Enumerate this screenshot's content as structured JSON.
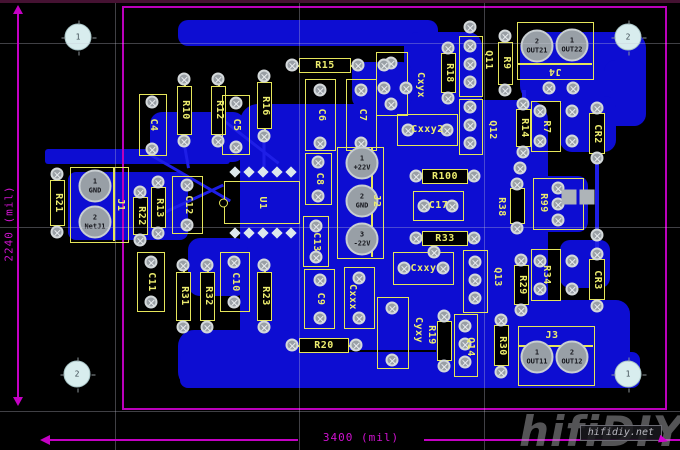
{
  "view": {
    "type": "pcb-layout-editor"
  },
  "board": {
    "x": 122,
    "y": 6,
    "w": 545,
    "h": 404
  },
  "colors": {
    "background": "#000000",
    "copper": "#0d0dd2",
    "silkscreen": "#e6e65a",
    "board_outline": "#bb00bb",
    "pad": "#9aa0a6",
    "dimension": "#cf12cf"
  },
  "dimensions": {
    "vertical": "2240 (mil)",
    "horizontal": "3400 (mil)"
  },
  "watermark": {
    "big": "hifiDIY",
    "small": "hifidiy.net"
  },
  "grid": {
    "v": [
      115,
      299,
      484
    ],
    "h": [
      43,
      227,
      411
    ]
  },
  "copper": {
    "pours": [
      [
        178,
        20,
        260,
        26,
        10
      ],
      [
        404,
        32,
        78,
        84,
        14
      ],
      [
        520,
        32,
        126,
        70,
        16
      ],
      [
        604,
        60,
        42,
        66,
        12
      ],
      [
        352,
        62,
        60,
        46,
        10
      ],
      [
        240,
        104,
        290,
        246,
        18
      ],
      [
        150,
        112,
        95,
        50,
        12
      ],
      [
        45,
        149,
        185,
        15,
        3
      ],
      [
        68,
        172,
        120,
        68,
        8
      ],
      [
        188,
        238,
        60,
        58,
        12
      ],
      [
        178,
        330,
        122,
        58,
        16
      ],
      [
        180,
        352,
        460,
        36,
        8
      ],
      [
        436,
        100,
        112,
        270,
        20
      ],
      [
        528,
        176,
        60,
        56,
        10
      ],
      [
        524,
        300,
        106,
        78,
        14
      ],
      [
        560,
        96,
        56,
        56,
        12
      ],
      [
        560,
        240,
        50,
        48,
        10
      ]
    ],
    "segments": [
      [
        148,
        152,
        95,
        30,
        3
      ],
      [
        158,
        214,
        72,
        -25,
        3
      ],
      [
        225,
        120,
        68,
        38,
        3
      ],
      [
        597,
        160,
        92,
        90,
        4
      ],
      [
        264,
        136,
        30,
        90,
        3
      ],
      [
        184,
        141,
        26,
        80,
        3
      ],
      [
        524,
        88,
        46,
        90,
        4
      ],
      [
        470,
        97,
        12,
        90,
        4
      ]
    ]
  },
  "components": [
    {
      "id": "C4",
      "label": "C4",
      "type": "cap",
      "x": 139,
      "y": 94,
      "w": 28,
      "h": 62,
      "rot": "v"
    },
    {
      "id": "R10",
      "label": "R10",
      "type": "res",
      "x": 177,
      "y": 77,
      "w": 15,
      "h": 66,
      "rot": "v"
    },
    {
      "id": "R12",
      "label": "R12",
      "type": "res",
      "x": 211,
      "y": 77,
      "w": 15,
      "h": 66,
      "rot": "v"
    },
    {
      "id": "C5",
      "label": "C5",
      "type": "cap",
      "x": 222,
      "y": 95,
      "w": 28,
      "h": 60,
      "rot": "v"
    },
    {
      "id": "R16",
      "label": "R16",
      "type": "res",
      "x": 257,
      "y": 74,
      "w": 15,
      "h": 64,
      "rot": "v"
    },
    {
      "id": "R15",
      "label": "R15",
      "type": "res",
      "x": 290,
      "y": 58,
      "w": 70,
      "h": 15,
      "rot": "h"
    },
    {
      "id": "C6",
      "label": "C6",
      "type": "cap",
      "x": 305,
      "y": 79,
      "w": 31,
      "h": 72,
      "rot": "v"
    },
    {
      "id": "C7",
      "label": "C7",
      "type": "cap",
      "x": 346,
      "y": 79,
      "w": 31,
      "h": 72,
      "rot": "v"
    },
    {
      "id": "C8",
      "label": "C8",
      "type": "cap",
      "x": 305,
      "y": 153,
      "w": 27,
      "h": 52,
      "rot": "v"
    },
    {
      "id": "C13",
      "label": "C13",
      "type": "cap",
      "x": 303,
      "y": 216,
      "w": 26,
      "h": 51,
      "rot": "v"
    },
    {
      "id": "C9",
      "label": "C9",
      "type": "cap",
      "x": 304,
      "y": 269,
      "w": 31,
      "h": 60,
      "rot": "v"
    },
    {
      "id": "R20",
      "label": "R20",
      "type": "res",
      "x": 290,
      "y": 338,
      "w": 68,
      "h": 15,
      "rot": "h"
    },
    {
      "id": "U1",
      "label": "U1",
      "type": "ic",
      "x": 224,
      "y": 181,
      "w": 76,
      "h": 43,
      "rot": "v"
    },
    {
      "id": "R21",
      "label": "R21",
      "type": "res",
      "x": 50,
      "y": 172,
      "w": 15,
      "h": 62,
      "rot": "v"
    },
    {
      "id": "J1",
      "label": "J1",
      "type": "conn",
      "x": 70,
      "y": 167,
      "w": 59,
      "h": 76,
      "rot": "v",
      "divider": {
        "o": "v",
        "p": 42
      },
      "lx": 120,
      "ly": 205
    },
    {
      "id": "R22",
      "label": "R22",
      "type": "res",
      "x": 133,
      "y": 190,
      "w": 15,
      "h": 52,
      "rot": "v"
    },
    {
      "id": "R13",
      "label": "R13",
      "type": "res",
      "x": 151,
      "y": 180,
      "w": 15,
      "h": 55,
      "rot": "v"
    },
    {
      "id": "C12",
      "label": "C12",
      "type": "cap",
      "x": 172,
      "y": 176,
      "w": 31,
      "h": 58,
      "rot": "v"
    },
    {
      "id": "C11",
      "label": "C11",
      "type": "cap",
      "x": 137,
      "y": 252,
      "w": 28,
      "h": 60,
      "rot": "v"
    },
    {
      "id": "R31",
      "label": "R31",
      "type": "res",
      "x": 176,
      "y": 263,
      "w": 15,
      "h": 66,
      "rot": "v"
    },
    {
      "id": "R32",
      "label": "R32",
      "type": "res",
      "x": 200,
      "y": 263,
      "w": 15,
      "h": 66,
      "rot": "v"
    },
    {
      "id": "C10",
      "label": "C10",
      "type": "cap",
      "x": 220,
      "y": 252,
      "w": 30,
      "h": 60,
      "rot": "v"
    },
    {
      "id": "R23",
      "label": "R23",
      "type": "res",
      "x": 257,
      "y": 263,
      "w": 15,
      "h": 66,
      "rot": "v"
    },
    {
      "id": "J2",
      "label": "J2",
      "type": "conn",
      "x": 337,
      "y": 147,
      "w": 47,
      "h": 112,
      "rot": "v",
      "divider": {
        "o": "v",
        "p": 33
      },
      "lx": 376,
      "ly": 201
    },
    {
      "id": "R100",
      "label": "R100",
      "type": "res",
      "x": 414,
      "y": 169,
      "w": 62,
      "h": 15,
      "rot": "h"
    },
    {
      "id": "C17",
      "label": "C17",
      "type": "cap",
      "x": 413,
      "y": 191,
      "w": 51,
      "h": 30,
      "rot": "h"
    },
    {
      "id": "R33",
      "label": "R33",
      "type": "res",
      "x": 414,
      "y": 231,
      "w": 62,
      "h": 15,
      "rot": "h"
    },
    {
      "id": "Cxxy",
      "label": "Cxxy",
      "type": "cap",
      "x": 393,
      "y": 252,
      "w": 61,
      "h": 33,
      "rot": "h"
    },
    {
      "id": "Cxyx",
      "label": "Cxyx",
      "type": "cap",
      "x": 376,
      "y": 52,
      "w": 32,
      "h": 64,
      "rot": "v",
      "lx": 420,
      "ly": 85
    },
    {
      "id": "Cxxy2",
      "label": "Cxxy2",
      "type": "cap",
      "x": 397,
      "y": 114,
      "w": 61,
      "h": 32,
      "rot": "h"
    },
    {
      "id": "R18",
      "label": "R18",
      "type": "res",
      "x": 441,
      "y": 46,
      "w": 15,
      "h": 54,
      "rot": "v"
    },
    {
      "id": "Q11",
      "label": "Q11",
      "type": "pins",
      "x": 459,
      "y": 36,
      "w": 24,
      "h": 61,
      "rot": "v",
      "lx": 488,
      "ly": 60
    },
    {
      "id": "Q12",
      "label": "Q12",
      "type": "pins",
      "x": 459,
      "y": 99,
      "w": 24,
      "h": 56,
      "rot": "v",
      "lx": 492,
      "ly": 130
    },
    {
      "id": "R9",
      "label": "R9",
      "type": "res",
      "x": 498,
      "y": 34,
      "w": 15,
      "h": 58,
      "rot": "v"
    },
    {
      "id": "R14",
      "label": "R14",
      "type": "res",
      "x": 516,
      "y": 102,
      "w": 15,
      "h": 52,
      "rot": "v"
    },
    {
      "id": "J4",
      "label": "J4",
      "type": "conn",
      "x": 517,
      "y": 22,
      "w": 77,
      "h": 58,
      "rot": "180",
      "divider": {
        "o": "h",
        "p": 40
      },
      "lx": 555,
      "ly": 71
    },
    {
      "id": "R7",
      "label": "R7",
      "type": "cap",
      "x": 531,
      "y": 101,
      "w": 30,
      "h": 51,
      "rot": "v"
    },
    {
      "id": "CR2",
      "label": "CR2",
      "type": "res",
      "x": 589,
      "y": 106,
      "w": 16,
      "h": 56,
      "rot": "v"
    },
    {
      "id": "R38",
      "label": "R38",
      "type": "res",
      "x": 510,
      "y": 182,
      "w": 15,
      "h": 48,
      "rot": "v",
      "lx": 501,
      "ly": 207
    },
    {
      "id": "R99",
      "label": "R99",
      "type": "cap",
      "x": 533,
      "y": 178,
      "w": 51,
      "h": 52,
      "rot": "v",
      "lx": 543,
      "ly": 203
    },
    {
      "id": "Q13",
      "label": "Q13",
      "type": "pins",
      "x": 463,
      "y": 250,
      "w": 25,
      "h": 63,
      "rot": "v",
      "lx": 497,
      "ly": 277
    },
    {
      "id": "R29",
      "label": "R29",
      "type": "res",
      "x": 514,
      "y": 258,
      "w": 15,
      "h": 54,
      "rot": "v"
    },
    {
      "id": "R34",
      "label": "R34",
      "type": "cap",
      "x": 531,
      "y": 249,
      "w": 30,
      "h": 52,
      "rot": "v"
    },
    {
      "id": "CR3",
      "label": "CR3",
      "type": "res",
      "x": 589,
      "y": 252,
      "w": 16,
      "h": 56,
      "rot": "v"
    },
    {
      "id": "Q14",
      "label": "Q14",
      "type": "pins",
      "x": 454,
      "y": 314,
      "w": 24,
      "h": 63,
      "rot": "v",
      "lx": 470,
      "ly": 347
    },
    {
      "id": "R30",
      "label": "R30",
      "type": "res",
      "x": 494,
      "y": 318,
      "w": 15,
      "h": 56,
      "rot": "v"
    },
    {
      "id": "J3",
      "label": "J3",
      "type": "conn",
      "x": 518,
      "y": 326,
      "w": 77,
      "h": 60,
      "rot": "h",
      "divider": {
        "o": "h",
        "p": 18
      },
      "lx": 552,
      "ly": 336
    },
    {
      "id": "R19",
      "label": "R19",
      "type": "res",
      "x": 437,
      "y": 314,
      "w": 15,
      "h": 54,
      "rot": "v",
      "lx": 431,
      "ly": 335
    },
    {
      "id": "Cyxy",
      "label": "Cyxy",
      "type": "cap",
      "x": 377,
      "y": 297,
      "w": 32,
      "h": 72,
      "rot": "v",
      "lx": 418,
      "ly": 330
    },
    {
      "id": "Cxxx",
      "label": "Cxxx",
      "type": "cap",
      "x": 344,
      "y": 267,
      "w": 31,
      "h": 62,
      "rot": "v",
      "lx": 352,
      "ly": 297
    }
  ],
  "pads": {
    "vias": [
      [
        152,
        102
      ],
      [
        152,
        149
      ],
      [
        184,
        79
      ],
      [
        184,
        141
      ],
      [
        218,
        79
      ],
      [
        218,
        141
      ],
      [
        236,
        103
      ],
      [
        236,
        147
      ],
      [
        264,
        76
      ],
      [
        264,
        136
      ],
      [
        292,
        65
      ],
      [
        358,
        65
      ],
      [
        320,
        90
      ],
      [
        320,
        143
      ],
      [
        361,
        90
      ],
      [
        361,
        143
      ],
      [
        318,
        162
      ],
      [
        318,
        196
      ],
      [
        316,
        226
      ],
      [
        316,
        257
      ],
      [
        320,
        280
      ],
      [
        320,
        318
      ],
      [
        292,
        345
      ],
      [
        356,
        345
      ],
      [
        57,
        174
      ],
      [
        57,
        232
      ],
      [
        140,
        192
      ],
      [
        140,
        240
      ],
      [
        158,
        182
      ],
      [
        158,
        233
      ],
      [
        187,
        185
      ],
      [
        187,
        225
      ],
      [
        151,
        262
      ],
      [
        151,
        302
      ],
      [
        183,
        265
      ],
      [
        183,
        327
      ],
      [
        207,
        265
      ],
      [
        207,
        327
      ],
      [
        234,
        262
      ],
      [
        234,
        302
      ],
      [
        264,
        265
      ],
      [
        264,
        327
      ],
      [
        416,
        176
      ],
      [
        474,
        176
      ],
      [
        424,
        206
      ],
      [
        452,
        206
      ],
      [
        416,
        238
      ],
      [
        474,
        238
      ],
      [
        404,
        268
      ],
      [
        443,
        268
      ],
      [
        391,
        63
      ],
      [
        391,
        104
      ],
      [
        408,
        130
      ],
      [
        447,
        130
      ],
      [
        448,
        48
      ],
      [
        448,
        98
      ],
      [
        470,
        46
      ],
      [
        470,
        64
      ],
      [
        470,
        82
      ],
      [
        470,
        107
      ],
      [
        470,
        125
      ],
      [
        470,
        143
      ],
      [
        505,
        36
      ],
      [
        505,
        90
      ],
      [
        523,
        104
      ],
      [
        523,
        152
      ],
      [
        540,
        111
      ],
      [
        540,
        141
      ],
      [
        572,
        111
      ],
      [
        572,
        141
      ],
      [
        597,
        108
      ],
      [
        597,
        158
      ],
      [
        517,
        184
      ],
      [
        517,
        228
      ],
      [
        558,
        188
      ],
      [
        558,
        204
      ],
      [
        558,
        220
      ],
      [
        475,
        262
      ],
      [
        475,
        280
      ],
      [
        475,
        298
      ],
      [
        521,
        260
      ],
      [
        521,
        310
      ],
      [
        540,
        261
      ],
      [
        540,
        289
      ],
      [
        572,
        261
      ],
      [
        572,
        289
      ],
      [
        597,
        254
      ],
      [
        597,
        306
      ],
      [
        465,
        326
      ],
      [
        465,
        344
      ],
      [
        465,
        362
      ],
      [
        501,
        320
      ],
      [
        501,
        372
      ],
      [
        444,
        316
      ],
      [
        444,
        366
      ],
      [
        392,
        308
      ],
      [
        392,
        360
      ],
      [
        359,
        278
      ],
      [
        359,
        318
      ],
      [
        384,
        65
      ],
      [
        384,
        88
      ],
      [
        406,
        88
      ],
      [
        470,
        27
      ],
      [
        549,
        88
      ],
      [
        573,
        88
      ],
      [
        520,
        168
      ],
      [
        434,
        252
      ],
      [
        597,
        235
      ]
    ],
    "holes": [
      [
        "1",
        78,
        37
      ],
      [
        "2",
        628,
        37
      ],
      [
        "2",
        77,
        374
      ],
      [
        "1",
        628,
        374
      ]
    ],
    "power": [
      [
        "1",
        "GND",
        95,
        186
      ],
      [
        "2",
        "NetJ1",
        95,
        222
      ],
      [
        "1",
        "+22V",
        362,
        163
      ],
      [
        "2",
        "GND",
        362,
        201
      ],
      [
        "3",
        "-22V",
        362,
        239
      ],
      [
        "2",
        "OUT21",
        537,
        46
      ],
      [
        "1",
        "OUT22",
        572,
        45
      ],
      [
        "1",
        "OUT11",
        537,
        357
      ],
      [
        "2",
        "OUT12",
        572,
        357
      ]
    ],
    "squares": [
      [
        569,
        197
      ],
      [
        587,
        197
      ]
    ],
    "diamonds": [
      [
        235,
        172
      ],
      [
        249,
        172
      ],
      [
        263,
        172
      ],
      [
        277,
        172
      ],
      [
        291,
        172
      ],
      [
        235,
        233
      ],
      [
        249,
        233
      ],
      [
        263,
        233
      ],
      [
        277,
        233
      ],
      [
        291,
        233
      ]
    ]
  }
}
